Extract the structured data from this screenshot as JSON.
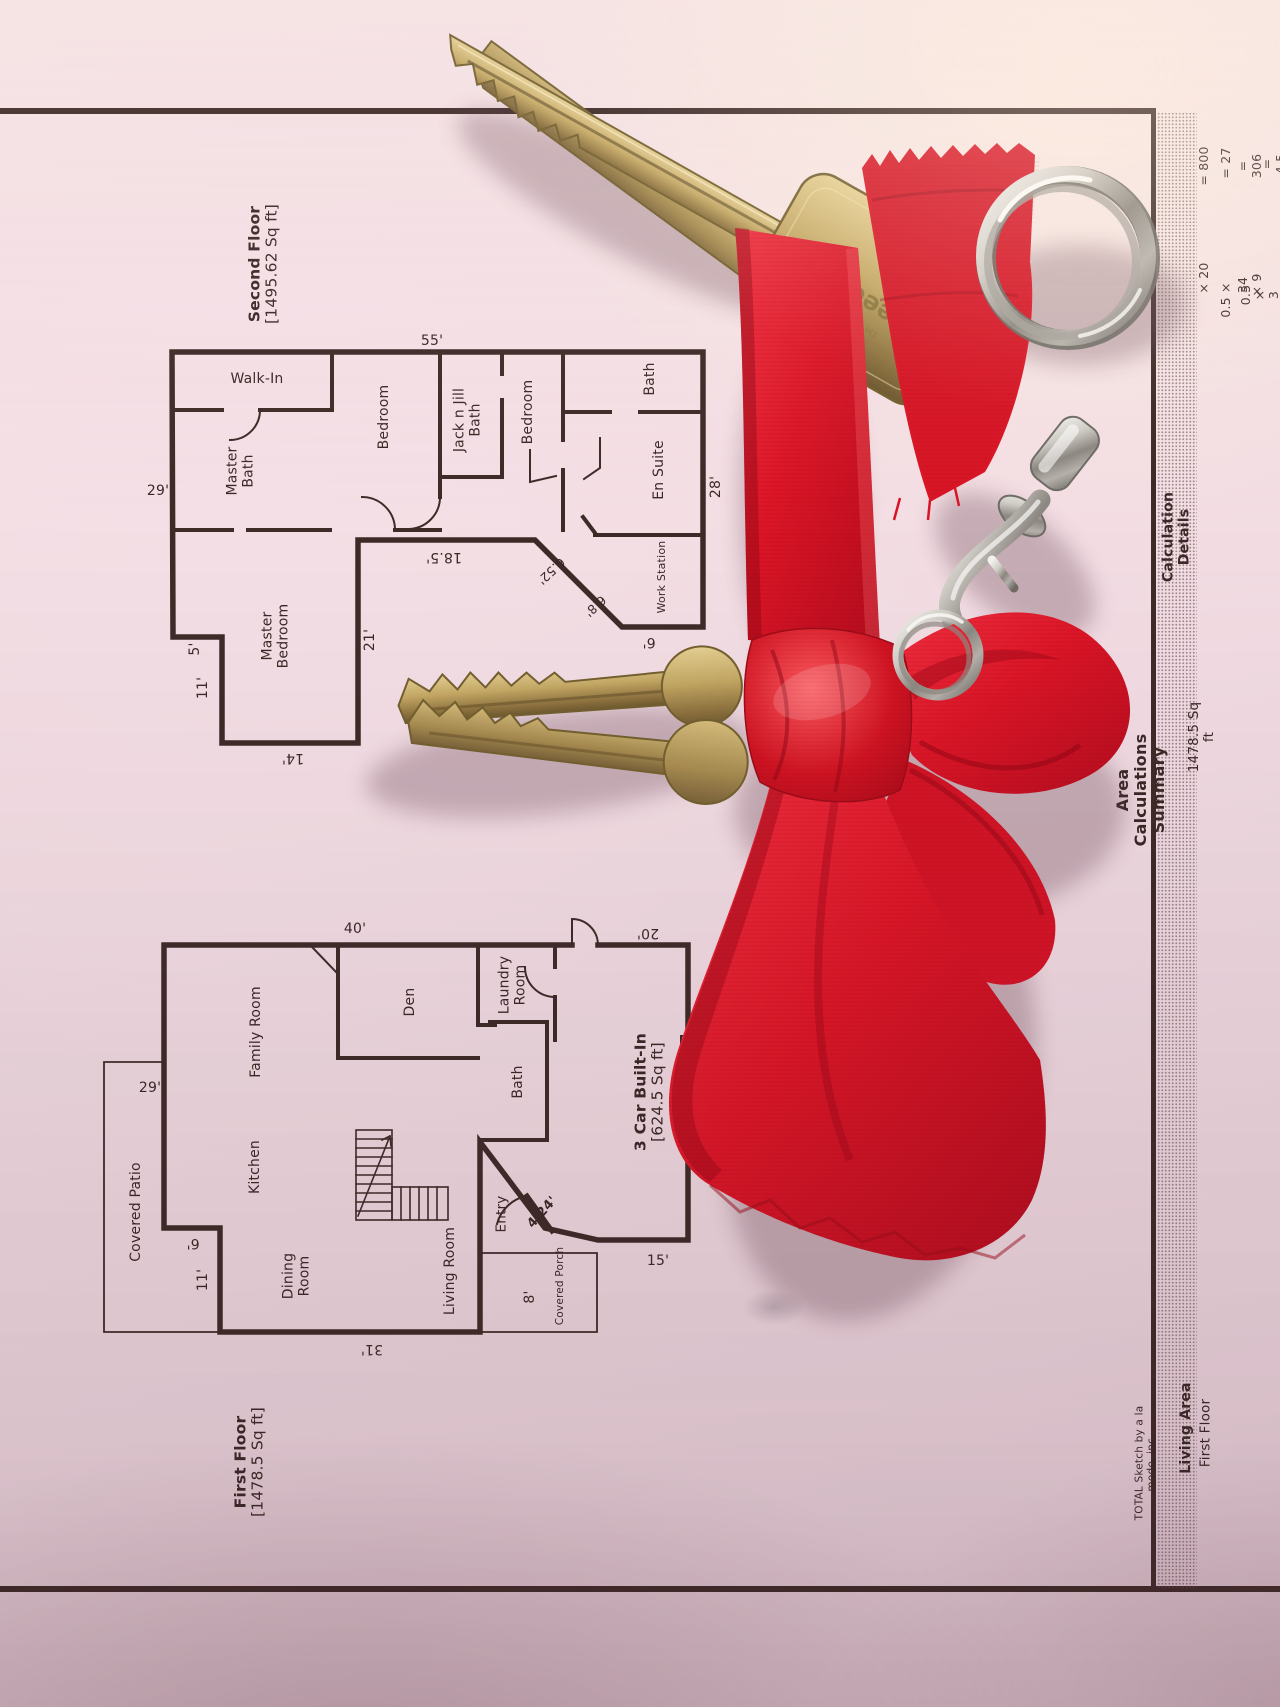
{
  "second_floor": {
    "title": "Second Floor\n[1495.62 Sq ft]",
    "rooms": {
      "walk_in": "Walk-In",
      "master_bath": "Master\nBath",
      "bedroom_left": "Bedroom",
      "jack_n_jill": "Jack n Jill\nBath",
      "bedroom_right": "Bedroom",
      "bath": "Bath",
      "en_suite": "En Suite",
      "work_station": "Work Station",
      "master_bedroom": "Master\nBedroom"
    },
    "dims": {
      "top": "55'",
      "left": "29'",
      "jog": "5'",
      "left_lower": "11'",
      "bottom": "14'",
      "inner_right": "21'",
      "inner_bottom": "18.5'",
      "diag_upper": "6.52'",
      "diag_lower": "6.8'",
      "bottom_right": "6'",
      "right": "28'"
    }
  },
  "first_floor": {
    "title": "First Floor\n[1478.5 Sq ft]",
    "rooms": {
      "covered_patio": "Covered Patio",
      "family_room": "Family Room",
      "kitchen": "Kitchen",
      "dining_room": "Dining\nRoom",
      "living_room": "Living Room",
      "den": "Den",
      "laundry_room": "Laundry\nRoom",
      "bath": "Bath",
      "entry": "Entry",
      "covered_porch": "Covered Porch",
      "garage": "3 Car Built-In\n[624.5 Sq ft]"
    },
    "dims": {
      "top": "40'",
      "garage_top": "20'",
      "patio_left": "29'",
      "jog": "6'",
      "left_lower": "11'",
      "bottom": "31'",
      "porch": "8'",
      "entry_door": "4.24'",
      "bottom_right": "15'"
    }
  },
  "summary": {
    "title": "Area Calculations Summary",
    "col_living": "Living Area",
    "col_details": "Calculation Details",
    "row_name": "First Floor",
    "row_value": "1478.5 Sq ft",
    "calc_rows": [
      {
        "expr": "× 20",
        "value": "= 800"
      },
      {
        "expr": "0.5 ×",
        "value": "= 27"
      },
      {
        "expr": "34 × 9",
        "value": "= 306"
      },
      {
        "expr": "0.5 × 3 × 3",
        "value": "= 4.5"
      }
    ],
    "footer": "TOTAL Sketch by a la mode, inc."
  },
  "objects": {
    "key_engraving": "eedom",
    "key_tm": "TM"
  },
  "colors": {
    "paper": "#f2dce3",
    "ink": "#3e2b28",
    "ribbon_red": "#dd1627",
    "brass": "#c3a763",
    "chrome": "#cfccc5"
  }
}
